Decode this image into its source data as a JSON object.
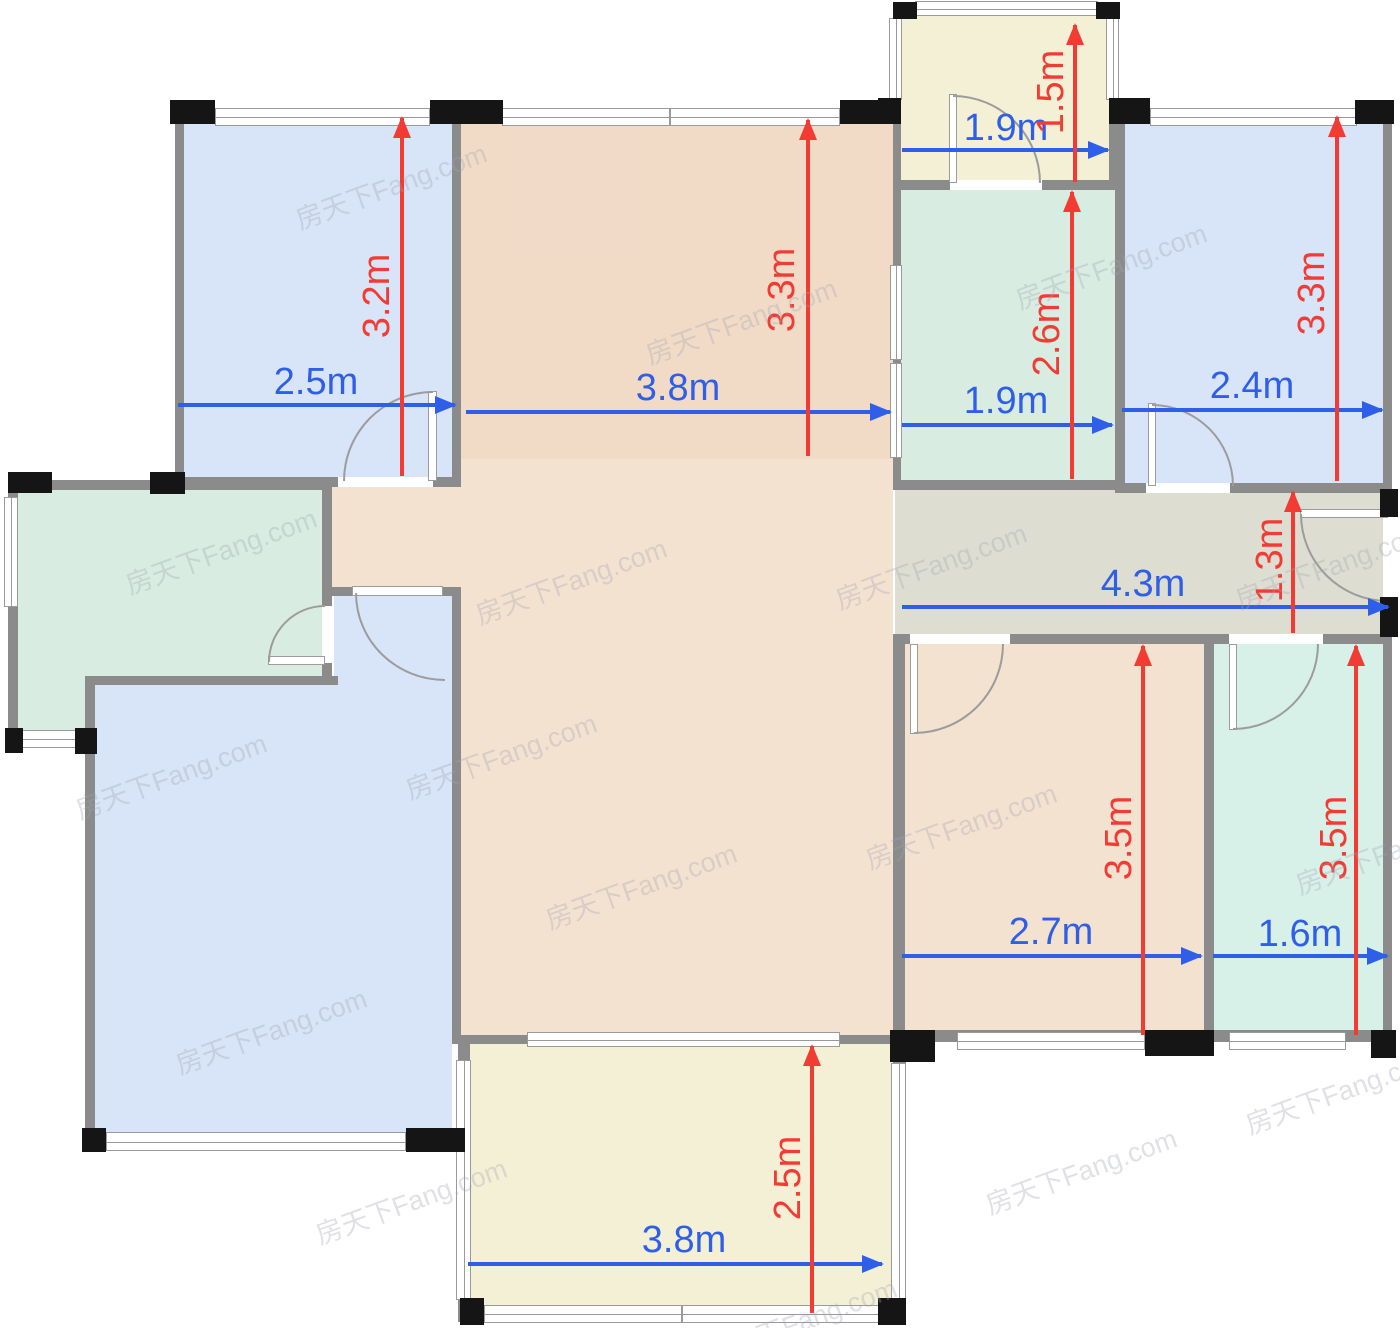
{
  "watermark": {
    "text": "房天下Fang.com"
  },
  "colors": {
    "room_blue": "#D8E4F8",
    "room_peach": "#F4E2D1",
    "room_yellow": "#F3F0D6",
    "room_teal": "#D8ECE1",
    "room_cyan": "#D7F0E8",
    "hallway_gray": "#DDDED1",
    "wall_gray": "#8B8B8B",
    "dim_blue": "#2F5FE8",
    "dim_red": "#F23B33"
  },
  "dimensions": [
    {
      "area": "bedroom-top-left",
      "width": "2.5m",
      "height": "3.2m"
    },
    {
      "area": "living-dining",
      "width": "3.8m",
      "height": "3.3m"
    },
    {
      "area": "balcony-top",
      "width": "1.9m",
      "height": "1.5m"
    },
    {
      "area": "bathroom",
      "width": "1.9m",
      "height": "2.6m"
    },
    {
      "area": "bedroom-top-right",
      "width": "2.4m",
      "height": "3.3m"
    },
    {
      "area": "hallway",
      "width": "4.3m",
      "height": "1.3m"
    },
    {
      "area": "bedroom-bottom-middle",
      "width": "2.7m",
      "height": "3.5m"
    },
    {
      "area": "room-bottom-right",
      "width": "1.6m",
      "height": "3.5m"
    },
    {
      "area": "balcony-bottom",
      "width": "3.8m",
      "height": "2.5m"
    }
  ]
}
